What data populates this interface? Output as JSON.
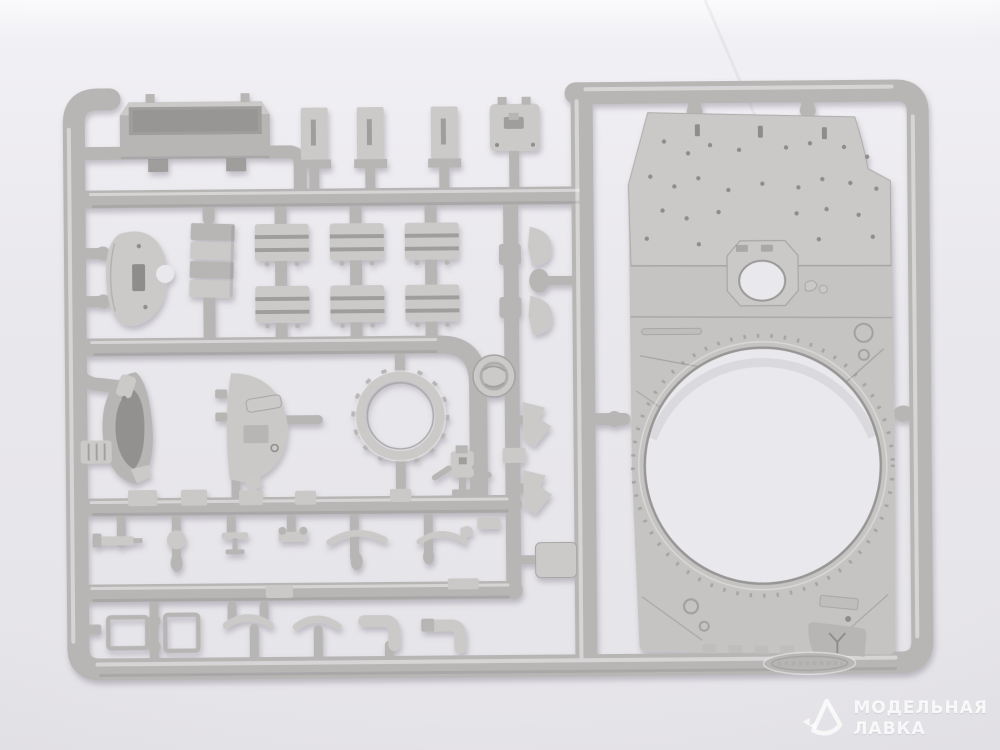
{
  "photo": {
    "subject": "injection-molded-styrene-sprue-with-model-kit-parts",
    "background": "seamless-light-studio-backdrop"
  },
  "watermark": {
    "line1": "МОДЕЛЬНАЯ",
    "line2": "ЛАВКА",
    "logo": "modelnaya-lavka-pick-logo"
  },
  "colors": {
    "backdrop_top": "#fbfafc",
    "backdrop": "#e9e8ec",
    "backdrop_bottom": "#e5e4e8",
    "plastic": "#b8b6b5",
    "plastic_light": "#cccac9",
    "plastic_dark": "#a09e9d",
    "panel": "#c6c4c2",
    "panel_light": "#cbc9c7",
    "panel_dark": "#c0bebc",
    "hole_shadow": "#8f8d8c",
    "shadow": "rgba(122,117,130,.45)",
    "watermark": "rgba(255,255,255,.85)"
  },
  "parts": [
    "sprue-frame-runners",
    "stowage-tray",
    "u-channel-brackets",
    "square-hatch-plate",
    "dome-cover",
    "ammo-box-stack",
    "ribbed-stowage-boxes",
    "curved-blade-fittings",
    "hatch-half-inner",
    "hatch-half-outer",
    "toothed-hatch-ring",
    "junction-disc",
    "periscope-part",
    "small-fittings-row",
    "tubular-frame-rails",
    "arc-bridges",
    "pipe-elbows",
    "lever-fittings",
    "hull-roof-panel-with-turret-ring-opening",
    "corner-gusset-tab",
    "molded-oval-stamp"
  ]
}
